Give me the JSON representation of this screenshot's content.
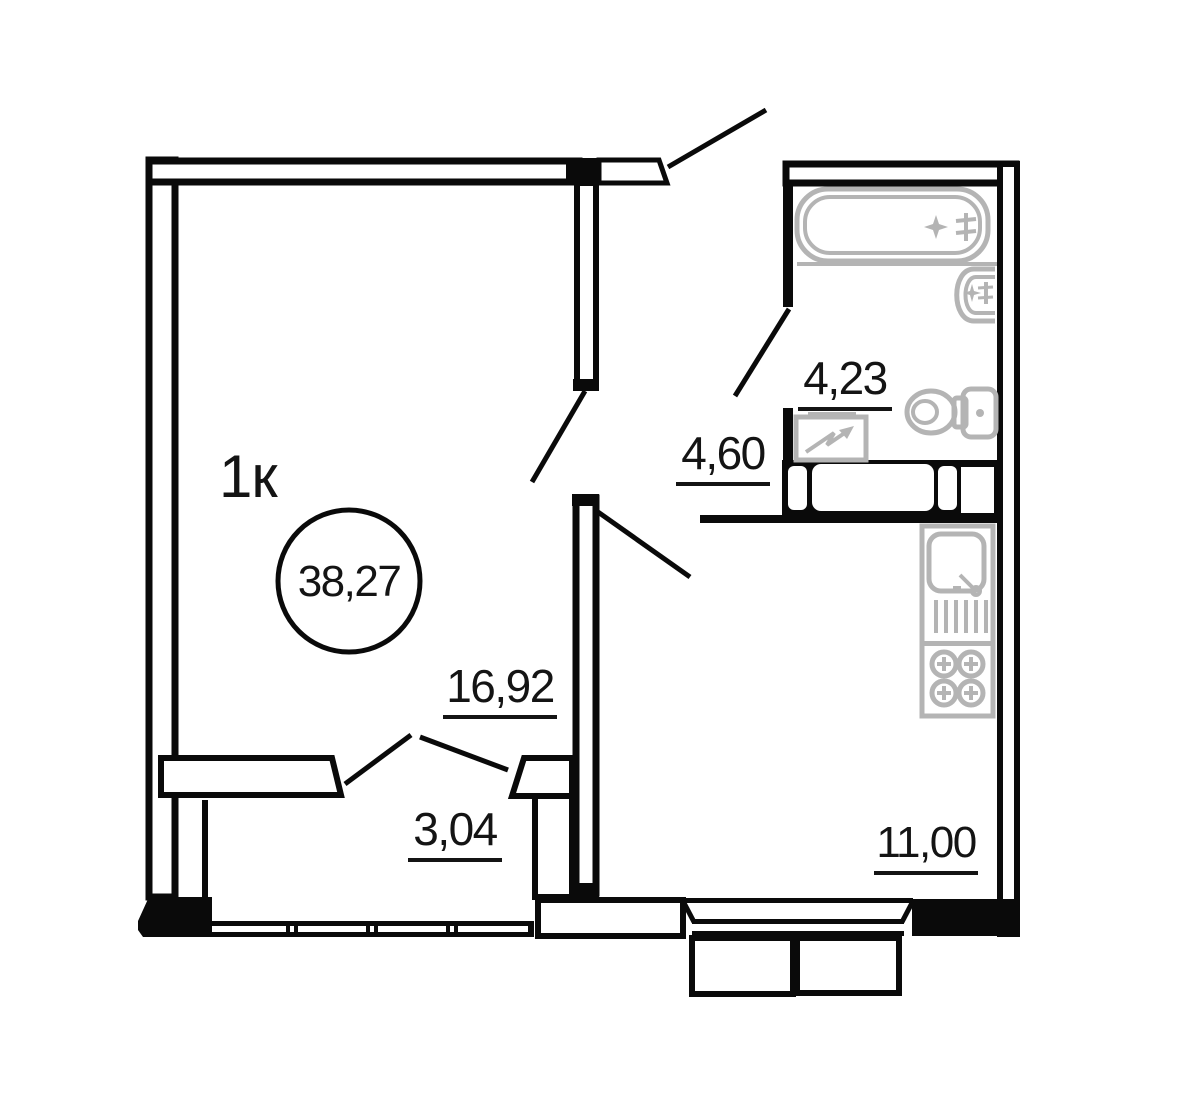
{
  "plan": {
    "apartment_type_label": "1к",
    "total_area": "38,27",
    "rooms": [
      {
        "id": "living-room",
        "area": "16,92"
      },
      {
        "id": "hall",
        "area": "3,04"
      },
      {
        "id": "corridor",
        "area": "4,60"
      },
      {
        "id": "bathroom",
        "area": "4,23"
      },
      {
        "id": "kitchen",
        "area": "11,00"
      }
    ],
    "fixtures": [
      "bathtub",
      "wash-basin",
      "toilet",
      "washing-machine",
      "kitchen-sink",
      "stove",
      "balcony"
    ],
    "colors": {
      "walls": "#0a0a0a",
      "fixtures": "#b4b4b4",
      "background": "#ffffff"
    }
  }
}
